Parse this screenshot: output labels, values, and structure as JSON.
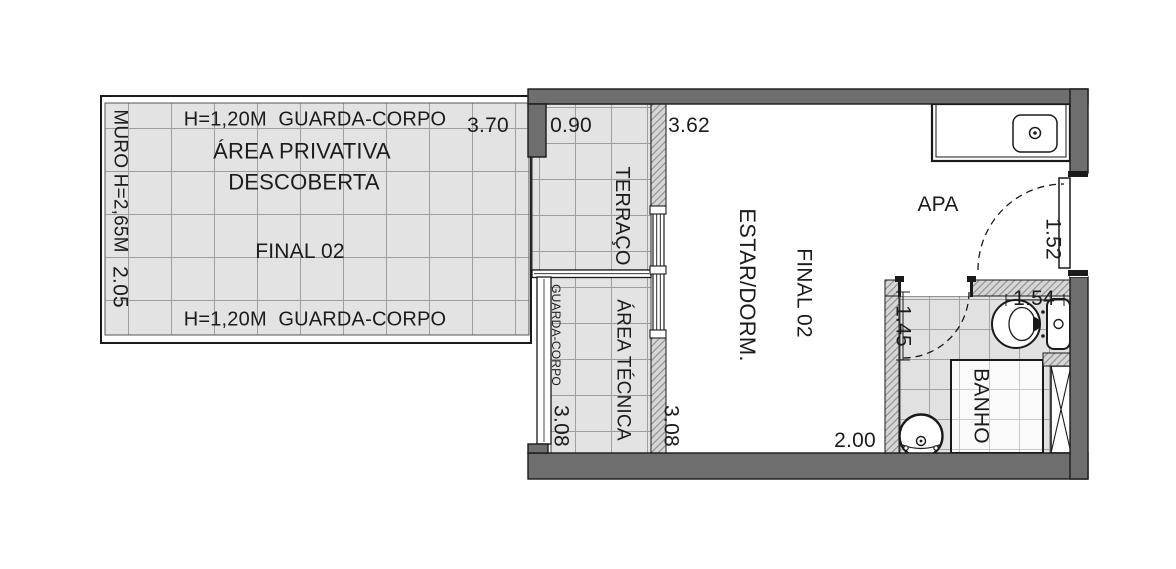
{
  "colors": {
    "wall_fill": "#6e6e6e",
    "tile_fill": "#e3e3e3",
    "tile_line": "#9f9f9f",
    "hatch_fill": "#d6d6d6",
    "hatch_line": "#8c8c8c",
    "outline": "#1a1a1a",
    "text": "#1c1c1c"
  },
  "private_area": {
    "railing_top": "H=1,20M  GUARDA-CORPO",
    "railing_bottom": "H=1,20M  GUARDA-CORPO",
    "name_line1": "ÁREA PRIVATIVA",
    "name_line2": "DESCOBERTA",
    "unit": "FINAL 02",
    "wall_label": "MURO H=2,65M",
    "dim_height": "2.05",
    "dim_width": "3.70"
  },
  "terrace": {
    "name": "TERRAÇO",
    "dim_width": "0.90"
  },
  "technical_area": {
    "name": "ÁREA TÉCNICA",
    "railing_label": "GUARDA-CORPO",
    "dim_height": "3.08"
  },
  "living": {
    "name": "ESTAR/DORM.",
    "unit": "FINAL 02",
    "dim_width": "3.62",
    "dim_height": "3.08",
    "dim_bath_wall": "2.00",
    "dim_entry": "1.52",
    "kitchen_label": "APA"
  },
  "bathroom": {
    "name": "BANHO",
    "dim_width": "1.54",
    "dim_door": "1.45"
  }
}
